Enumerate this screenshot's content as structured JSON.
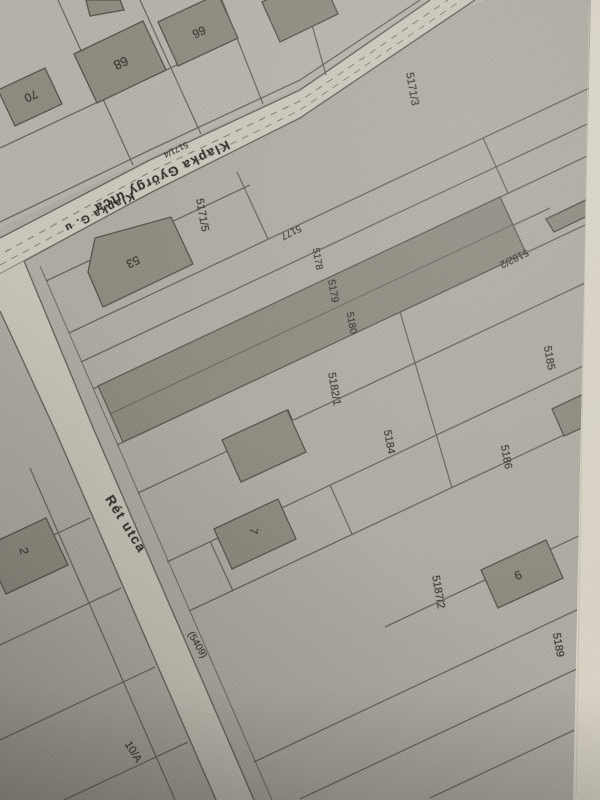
{
  "streets": [
    {
      "id": "klapka",
      "name": "Klapka György utca",
      "abbrev": "Klapka G. u",
      "street_parcel_number": "5171/4"
    },
    {
      "id": "ret",
      "name": "Rét utca",
      "street_parcel_number": "(5409)"
    }
  ],
  "parcel_numbers": [
    "5171/3",
    "5171/5",
    "5177",
    "5178",
    "5179",
    "5180",
    "5182/1",
    "5182/2",
    "5184",
    "5185",
    "5186",
    "5187/2",
    "5189"
  ],
  "house_numbers": [
    "2",
    "7",
    "9",
    "10/A",
    "53",
    "66",
    "68",
    "70"
  ],
  "colors": {
    "paper": "#aeaba2",
    "street_fill": "#cbc7bc",
    "building_fill": "#8d8a7f",
    "boundary_line": "#5f5b52",
    "paper_edge": "#d9d4c6",
    "label_text": "#3b3830"
  },
  "labels": [
    {
      "id": "street-klapka-full",
      "text": "Klapka György utca"
    },
    {
      "id": "street-klapka-short",
      "text": "Klapka G. u"
    },
    {
      "id": "parcel-5171-4",
      "text": "5171/4"
    },
    {
      "id": "parcel-5171-3",
      "text": "5171/3"
    },
    {
      "id": "parcel-5171-5",
      "text": "5171/5"
    },
    {
      "id": "house-53",
      "text": "53"
    },
    {
      "id": "house-66",
      "text": "66"
    },
    {
      "id": "house-68",
      "text": "68"
    },
    {
      "id": "house-70",
      "text": "70"
    },
    {
      "id": "parcel-5177",
      "text": "5177"
    },
    {
      "id": "parcel-5178",
      "text": "5178"
    },
    {
      "id": "parcel-5179",
      "text": "5179"
    },
    {
      "id": "parcel-5180",
      "text": "5180"
    },
    {
      "id": "parcel-5182-2",
      "text": "5182/2"
    },
    {
      "id": "parcel-5182-1",
      "text": "5182/1"
    },
    {
      "id": "parcel-5184",
      "text": "5184"
    },
    {
      "id": "parcel-5185",
      "text": "5185"
    },
    {
      "id": "parcel-5186",
      "text": "5186"
    },
    {
      "id": "house-7",
      "text": "7"
    },
    {
      "id": "house-9",
      "text": "9"
    },
    {
      "id": "parcel-5187-2",
      "text": "5187/2"
    },
    {
      "id": "parcel-5189",
      "text": "5189"
    },
    {
      "id": "house-2",
      "text": "2"
    },
    {
      "id": "street-ret",
      "text": "Rét utca"
    },
    {
      "id": "parcel-5409",
      "text": "(5409)"
    },
    {
      "id": "house-10a",
      "text": "10/A"
    }
  ]
}
